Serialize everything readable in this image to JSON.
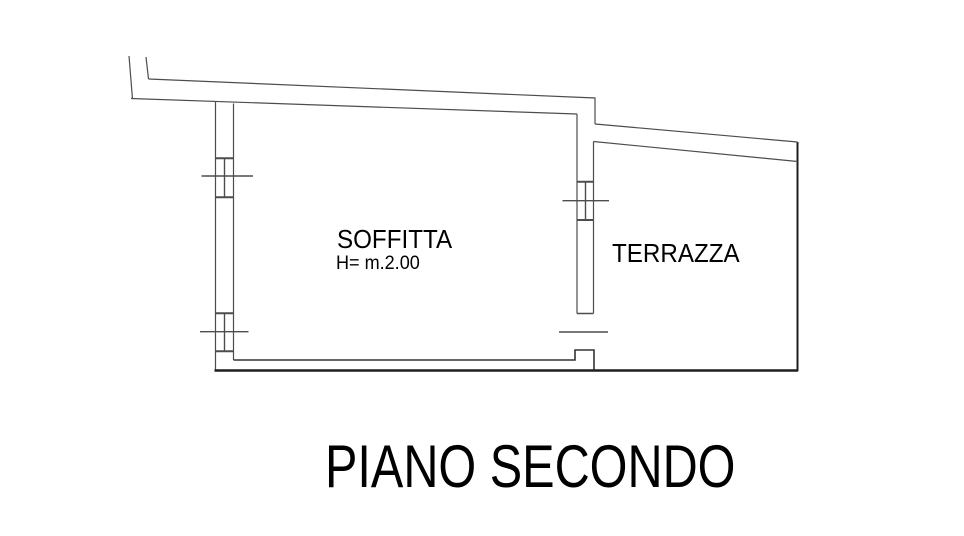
{
  "page": {
    "width": 964,
    "height": 536,
    "background": "#ffffff"
  },
  "colors": {
    "line_thin": "#4d4d4d",
    "line_dark": "#1f1f1f",
    "text": "#000000"
  },
  "labels": {
    "soffitta": "SOFFITTA",
    "soffitta_height": "H= m.2.00",
    "terrazza": "TERRAZZA",
    "floor_title": "PIANO SECONDO"
  },
  "floorplan": {
    "rooms": [
      {
        "name": "soffitta",
        "label": "SOFFITTA",
        "note": "H= m.2.00"
      },
      {
        "name": "terrazza",
        "label": "TERRAZZA"
      }
    ],
    "segments": [
      {
        "name": "stub-tick-left",
        "pts": [
          [
            129,
            56
          ],
          [
            132.5,
            99
          ]
        ]
      },
      {
        "name": "stub-tick-right",
        "pts": [
          [
            146,
            57
          ],
          [
            148.5,
            79
          ]
        ]
      },
      {
        "name": "top-wall-outer",
        "pts": [
          [
            148.5,
            79
          ],
          [
            595,
            98
          ],
          [
            595,
            124
          ]
        ]
      },
      {
        "name": "top-wall-inner",
        "pts": [
          [
            131,
            98.5
          ],
          [
            577,
            114
          ]
        ]
      },
      {
        "name": "left-wall-outer",
        "pts": [
          [
            215.5,
            102
          ],
          [
            215.5,
            370
          ]
        ]
      },
      {
        "name": "left-wall-inner",
        "pts": [
          [
            233.5,
            103.5
          ],
          [
            233.5,
            360
          ]
        ]
      },
      {
        "name": "bottom-wall-inner-edge",
        "pts": [
          [
            233.5,
            360
          ],
          [
            575,
            360
          ],
          [
            575,
            350
          ],
          [
            594,
            350
          ],
          [
            594,
            370
          ]
        ],
        "w": 1.6,
        "c": "#333333"
      },
      {
        "name": "bottom-parapet-line",
        "pts": [
          [
            214.5,
            370.5
          ],
          [
            798,
            370.5
          ]
        ],
        "w": 2.4,
        "c": "#1f1f1f"
      },
      {
        "name": "right-parapet-line",
        "pts": [
          [
            797.5,
            142
          ],
          [
            797.5,
            371
          ]
        ],
        "w": 2,
        "c": "#1f1f1f"
      },
      {
        "name": "divider-wall-left-line",
        "pts": [
          [
            577,
            114
          ],
          [
            577,
            313.5
          ]
        ]
      },
      {
        "name": "divider-wall-right-line",
        "pts": [
          [
            593.5,
            141.5
          ],
          [
            593.5,
            313.5
          ]
        ]
      },
      {
        "name": "divider-door-jamb",
        "pts": [
          [
            577,
            313.5
          ],
          [
            593.5,
            313.5
          ]
        ],
        "w": 1.6
      },
      {
        "name": "door-threshold-line",
        "pts": [
          [
            559,
            332
          ],
          [
            608,
            332
          ]
        ],
        "w": 1.4
      },
      {
        "name": "terrace-top-outer",
        "pts": [
          [
            595,
            124
          ],
          [
            797.5,
            142
          ]
        ]
      },
      {
        "name": "terrace-top-inner",
        "pts": [
          [
            593.5,
            141.5
          ],
          [
            797.5,
            161.5
          ]
        ]
      },
      {
        "name": "window-left-upper-cap-top",
        "pts": [
          [
            215.5,
            158.3
          ],
          [
            233.5,
            158.3
          ]
        ],
        "w": 2
      },
      {
        "name": "window-left-upper-cap-bottom",
        "pts": [
          [
            215.5,
            197.3
          ],
          [
            233.5,
            197.3
          ]
        ],
        "w": 2
      },
      {
        "name": "window-left-upper-center",
        "pts": [
          [
            224.5,
            158.3
          ],
          [
            224.5,
            197.3
          ]
        ],
        "w": 1.4
      },
      {
        "name": "window-left-upper-tick",
        "pts": [
          [
            201.5,
            176
          ],
          [
            253,
            176
          ]
        ],
        "w": 1.4
      },
      {
        "name": "window-left-lower-cap-top",
        "pts": [
          [
            215.5,
            313.3
          ],
          [
            233.5,
            313.3
          ]
        ],
        "w": 2
      },
      {
        "name": "window-left-lower-cap-bottom",
        "pts": [
          [
            215.5,
            351.3
          ],
          [
            233.5,
            351.3
          ]
        ],
        "w": 2
      },
      {
        "name": "window-left-lower-center",
        "pts": [
          [
            224.5,
            313.3
          ],
          [
            224.5,
            351.3
          ]
        ],
        "w": 1.4
      },
      {
        "name": "window-left-lower-tick",
        "pts": [
          [
            200,
            331.7
          ],
          [
            248.5,
            331.7
          ]
        ],
        "w": 1.4
      },
      {
        "name": "window-divider-cap-top",
        "pts": [
          [
            577,
            181.7
          ],
          [
            593.5,
            181.7
          ]
        ],
        "w": 2
      },
      {
        "name": "window-divider-cap-bottom",
        "pts": [
          [
            577,
            220
          ],
          [
            593.5,
            220
          ]
        ],
        "w": 2
      },
      {
        "name": "window-divider-center",
        "pts": [
          [
            585.5,
            181.7
          ],
          [
            585.5,
            220
          ]
        ],
        "w": 1.4
      },
      {
        "name": "window-divider-tick",
        "pts": [
          [
            562.5,
            200.7
          ],
          [
            609,
            200.7
          ]
        ],
        "w": 1.4
      }
    ]
  }
}
